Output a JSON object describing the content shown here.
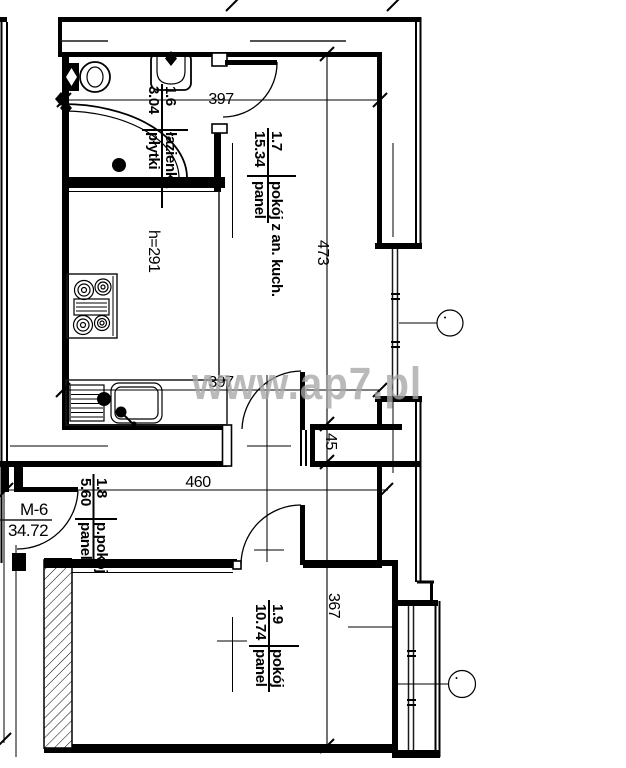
{
  "floor_plan": {
    "watermark": "www.ap7.pl",
    "apartment": {
      "code": "M-6",
      "total_area": "34.72"
    },
    "ceiling_height": "h=291",
    "rooms": [
      {
        "number": "1.6",
        "name": "łazienka",
        "area": "3.04",
        "floor": "płytki"
      },
      {
        "number": "1.7",
        "name": "pokój z an. kuch.",
        "area": "15.34",
        "floor": "panel"
      },
      {
        "number": "1.8",
        "name": "p.pokój",
        "area": "5.60",
        "floor": "panel"
      },
      {
        "number": "1.9",
        "name": "pokój",
        "area": "10.74",
        "floor": "panel"
      }
    ],
    "dimensions": {
      "bathroom_width": "397",
      "room_bottom_width": "397",
      "hallway_width": "460",
      "main_room_depth": "473",
      "wall_offset": "45",
      "bedroom_depth": "367"
    }
  }
}
